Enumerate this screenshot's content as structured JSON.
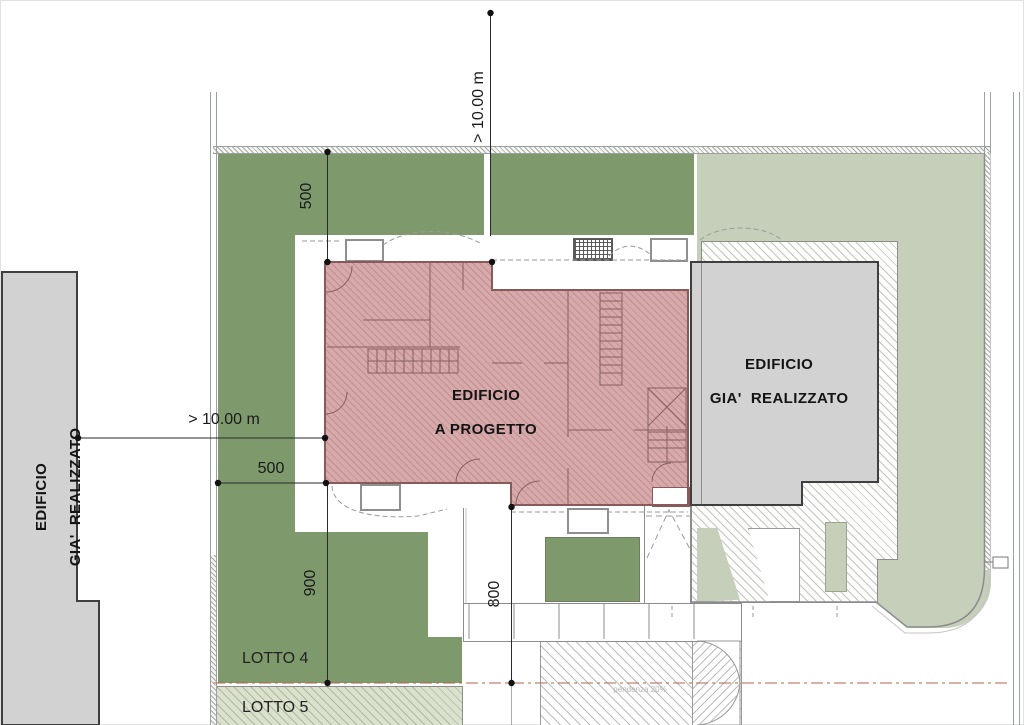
{
  "colors": {
    "lawn_dark": "#7e9a6d",
    "lawn_light": "#c6cfba",
    "project_fill": "#d6a9aa",
    "existing_fill": "#d2d2d2",
    "centerline_red": "#b4624f"
  },
  "buildings": {
    "project": {
      "line1": "EDIFICIO",
      "line2": "A PROGETTO"
    },
    "existing_right": {
      "line1": "EDIFICIO",
      "line2": "GIA'  REALIZZATO"
    },
    "existing_left": {
      "line1": "EDIFICIO",
      "line2": "GIA'  REALIZZATO"
    }
  },
  "dimensions": {
    "top_setback": "> 10.00 m",
    "left_setback": "> 10.00 m",
    "top_offset": "500",
    "left_offset": "500",
    "left_depth": "900",
    "center_depth": "800"
  },
  "lots": {
    "lotto4": "LOTTO 4",
    "lotto5": "LOTTO 5"
  },
  "notes": {
    "slope": "pendenza 20%"
  }
}
